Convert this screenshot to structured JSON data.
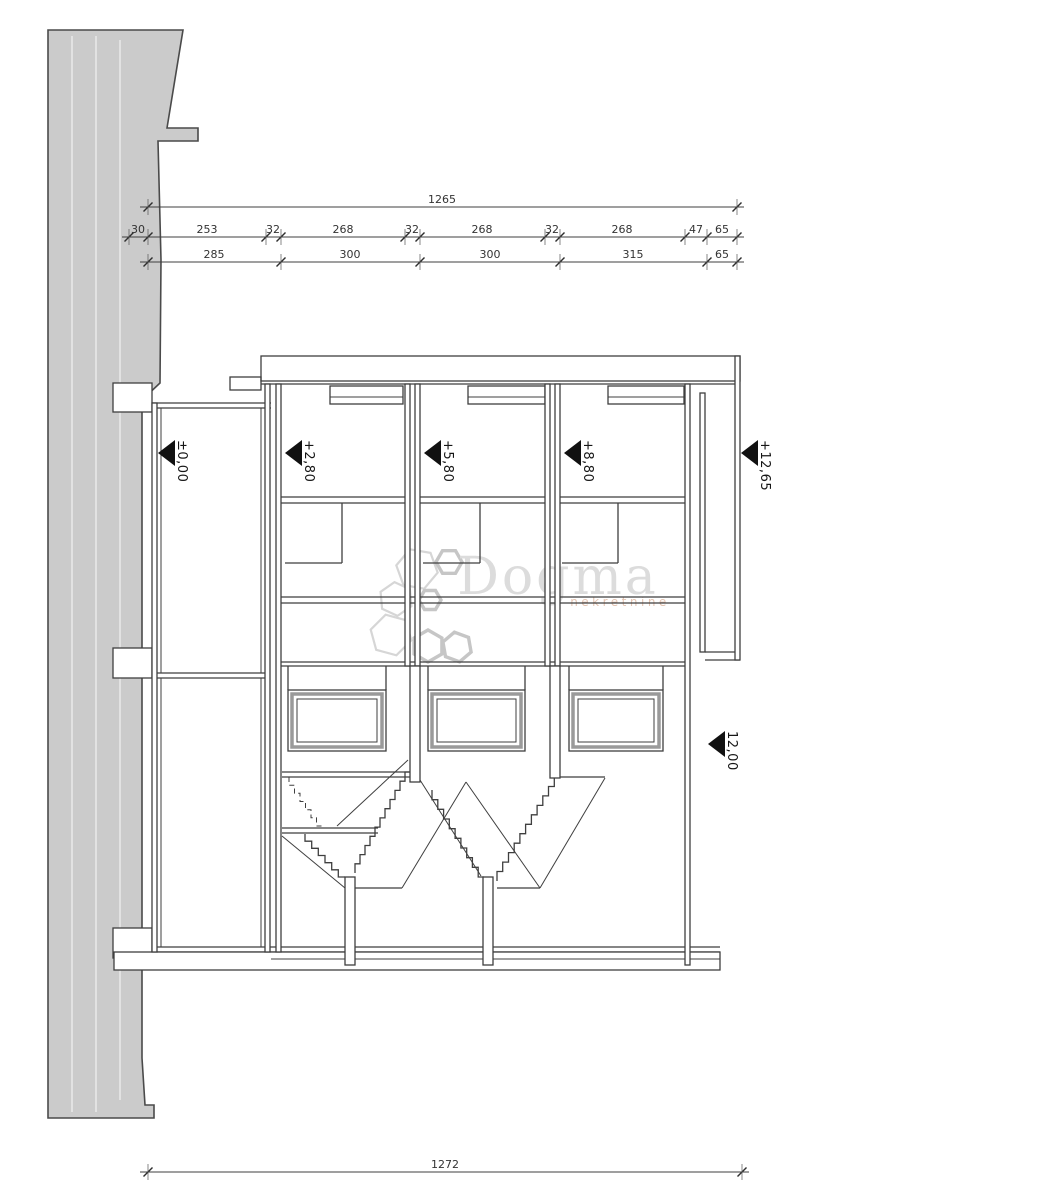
{
  "watermark": {
    "brand": "Dogma",
    "subtitle": "nekretnine"
  },
  "levels": {
    "l1": "±0,00",
    "l2": "+2,80",
    "l3": "+5,80",
    "l4": "+8,80",
    "l5": "+12,65",
    "l6": "12,00"
  },
  "dims": {
    "total_top": "1265",
    "row2": [
      "30",
      "253",
      "32",
      "268",
      "32",
      "268",
      "32",
      "268",
      "47",
      "65"
    ],
    "row3": [
      "285",
      "300",
      "300",
      "315",
      "65"
    ],
    "total_bottom": "1272"
  },
  "colors": {
    "line": "#3f3f3f",
    "terrain": "#cbcbcb",
    "terrain_edge": "#4a4a4a",
    "watermark": "#dcdcdc",
    "watermark_sub": "#e4c4b2"
  }
}
